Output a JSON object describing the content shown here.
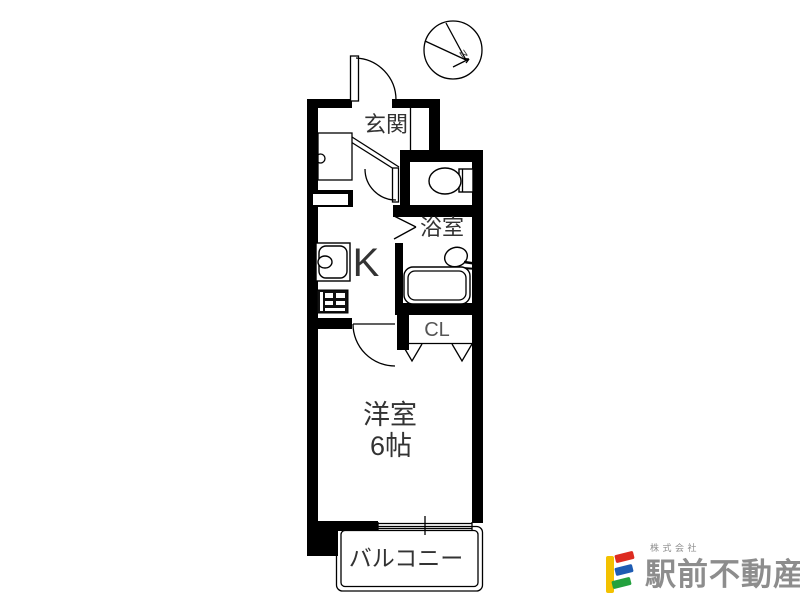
{
  "floorplan": {
    "rooms": {
      "entrance_label": "玄関",
      "bath_label": "浴室",
      "kitchen_label": "K",
      "closet_label": "CL",
      "main_room_label": "洋室",
      "main_room_size": "6帖",
      "balcony_label": "バルコニー"
    },
    "compass": {
      "north_label": "N"
    },
    "colors": {
      "wall": "#000000",
      "line": "#000000",
      "room_text": "#333333",
      "closet_text": "#555555"
    }
  },
  "logo": {
    "company_prefix": "株式会社",
    "company_name": "駅前不動産",
    "text_color": "#8d8d8d",
    "mark": {
      "bar_color": "#f3c100",
      "stripe_top_color": "#dd2b20",
      "stripe_middle_color": "#1e5cb3",
      "stripe_bottom_color": "#23a13e"
    }
  }
}
